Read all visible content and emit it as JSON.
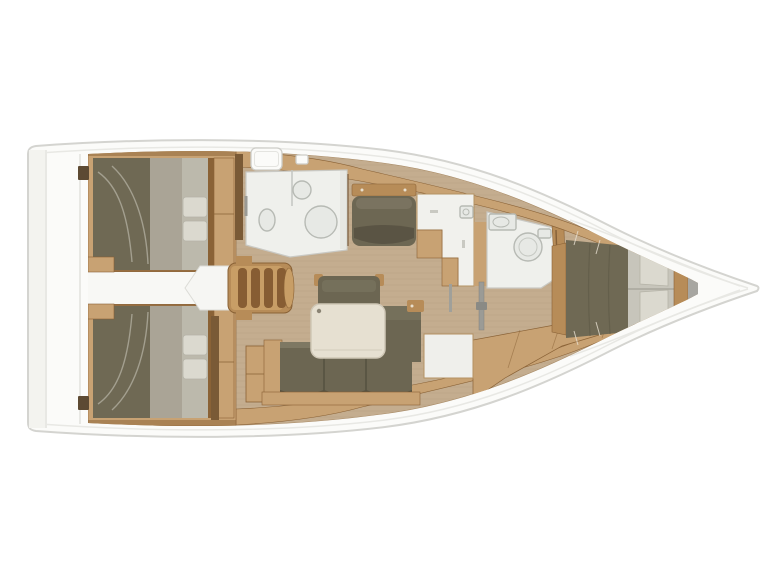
{
  "meta": {
    "type": "yacht-interior-floor-plan",
    "view": "top-down",
    "orientation": "bow-right",
    "canvas": {
      "width": 770,
      "height": 577
    }
  },
  "palette": {
    "page_bg": "#ffffff",
    "hull_outline": "#d4d4d0",
    "deck_white": "#fbfbf9",
    "deck_line": "#e8e8e4",
    "transom_shade": "#f3f3ef",
    "floor_tan": "#c4ad8f",
    "wood_light": "#c8a273",
    "wood_mid": "#b78c58",
    "wood_dark": "#8a6236",
    "wood_deep": "#6e4d2c",
    "stair_light": "#c89e66",
    "slat_brown": "#875d33",
    "mattress_olive": "#6f6954",
    "mattress_dark": "#5e5846",
    "bedding_grey": "#aaa496",
    "bedding_light": "#c7c5bb",
    "pillow_white": "#dbd9cf",
    "pillow_stroke": "#b5b3a7",
    "duvet_highlight": "#d8d5c9",
    "sofa_olive": "#6c6652",
    "sofa_light": "#7e7863",
    "sofa_dark": "#55503f",
    "table_cream": "#e6e0d1",
    "table_stroke": "#cfc7b6",
    "bath_white": "#eff0ec",
    "bath_stroke": "#c9c9c4",
    "fixture_fill": "#e7e9e5",
    "fixture_stroke": "#b7bab4",
    "unit_white": "#f1f1ed",
    "unit_stroke": "#b49263",
    "corridor_white": "#f8f8f5",
    "hatch_stroke": "#cdcdc8",
    "metal_grey": "#9b9b96",
    "bulkhead_grey": "#a7a6a1",
    "post_brown": "#5d4a33",
    "pillow_column": "#bcb9ac"
  },
  "floorplan": {
    "vessel": "monohull sailing yacht interior layout",
    "rooms": [
      {
        "id": "transom-walkway",
        "label": "Transom / aft walkway"
      },
      {
        "id": "aft-cabin-port",
        "label": "Aft double cabin (port)"
      },
      {
        "id": "aft-cabin-starboard",
        "label": "Aft double cabin (starboard)"
      },
      {
        "id": "aft-corridor",
        "label": "Centre corridor between aft cabins"
      },
      {
        "id": "companionway",
        "label": "Companionway steps"
      },
      {
        "id": "aft-head",
        "label": "Aft head with shower (port)"
      },
      {
        "id": "salon",
        "label": "Saloon with L-sofa, chair and table"
      },
      {
        "id": "galley",
        "label": "Galley / nav units"
      },
      {
        "id": "forward-head",
        "label": "Forward head (port)"
      },
      {
        "id": "forward-cabin",
        "label": "Forward cabin with island double berth"
      },
      {
        "id": "bow-locker",
        "label": "Bow anchor locker"
      }
    ],
    "furniture": [
      "double-berth-port",
      "double-berth-starboard",
      "island-berth-forward",
      "l-shaped-sofa",
      "salon-table",
      "salon-chair",
      "bench-seat",
      "shower-enclosure",
      "toilet",
      "washbasin-aft",
      "washbasin-forward",
      "galley-counter",
      "fridge-counter",
      "companionway-steps",
      "mast-post",
      "deck-hatch-large",
      "deck-hatch-small"
    ]
  }
}
